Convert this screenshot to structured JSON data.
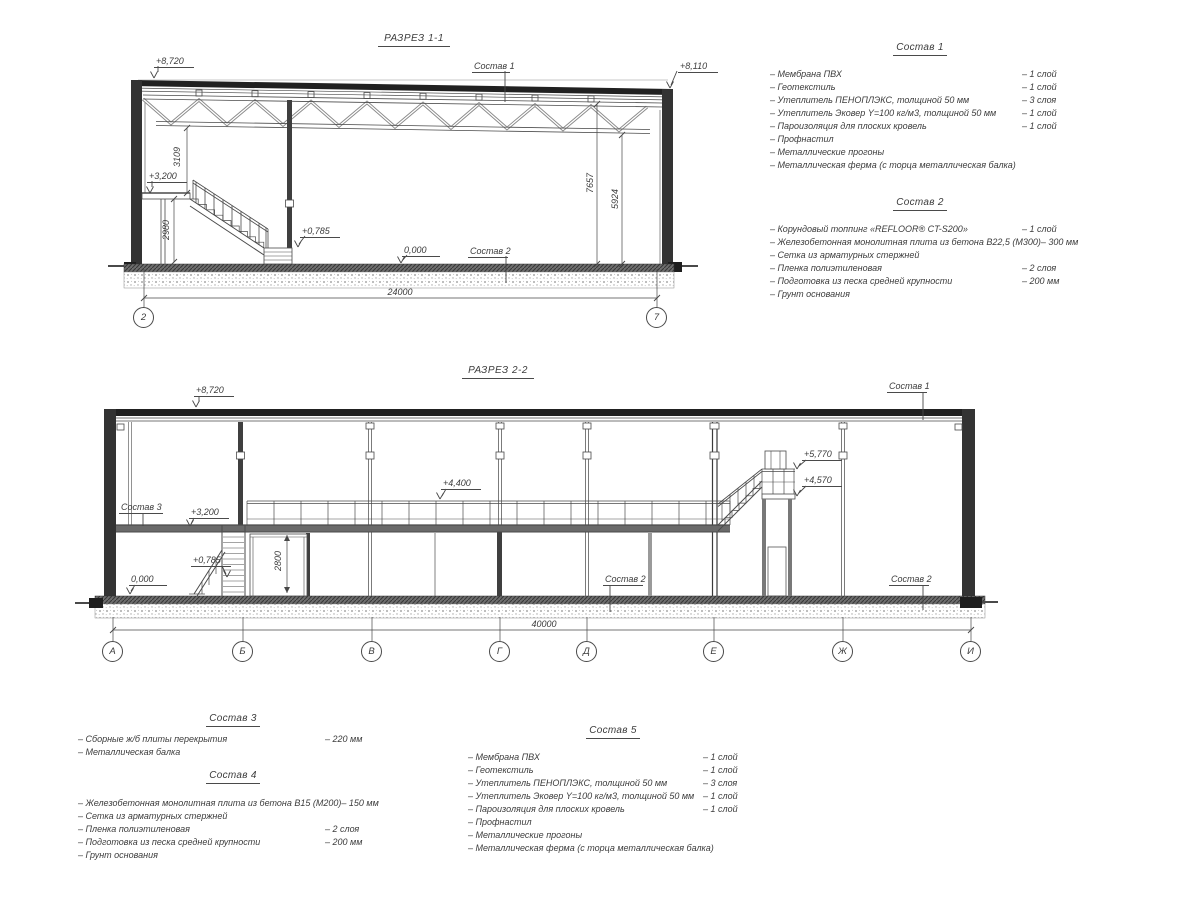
{
  "section1": {
    "title": "РАЗРЕЗ 1-1",
    "labels": {
      "elev_top_left": "+8,720",
      "elev_top_right": "+8,110",
      "sostav1": "Состав 1",
      "sostav2": "Состав 2",
      "elev_3200": "+3,200",
      "elev_0785": "+0,785",
      "elev_0000": "0,000",
      "dim_3109": "3109",
      "dim_2980": "2980",
      "dim_7657": "7657",
      "dim_5924": "5924",
      "dim_total": "24000",
      "axis_left": "2",
      "axis_right": "7"
    }
  },
  "section2": {
    "title": "РАЗРЕЗ 2-2",
    "labels": {
      "elev_top": "+8,720",
      "sostav1": "Состав 1",
      "sostav3": "Состав 3",
      "sostav2_mid": "Состав 2",
      "sostav2_right": "Состав 2",
      "elev_3200": "+3,200",
      "elev_4400": "+4,400",
      "elev_5770": "+5,770",
      "elev_4570": "+4,570",
      "elev_0785": "+0,785",
      "elev_0000": "0,000",
      "dim_2800": "2800",
      "dim_total": "40000"
    },
    "axes": [
      "А",
      "Б",
      "В",
      "Г",
      "Д",
      "Е",
      "Ж",
      "И"
    ]
  },
  "legends": {
    "s1": {
      "title": "Состав 1",
      "items": [
        {
          "name": "– Мембрана ПВХ",
          "value": "– 1 слой"
        },
        {
          "name": "– Геотекстиль",
          "value": "– 1 слой"
        },
        {
          "name": "– Утеплитель ПЕНОПЛЭКС, толщиной 50 мм",
          "value": "– 3 слоя"
        },
        {
          "name": "– Утеплитель Эковер Y=100 кг/м3, толщиной 50 мм",
          "value": "– 1 слой"
        },
        {
          "name": "– Пароизоляция для плоских кровель",
          "value": "– 1 слой"
        },
        {
          "name": "– Профнастил",
          "value": ""
        },
        {
          "name": "– Металлические прогоны",
          "value": ""
        },
        {
          "name": "– Металлическая ферма (с торца металлическая балка)",
          "value": ""
        }
      ]
    },
    "s2": {
      "title": "Состав 2",
      "items": [
        {
          "name": "– Корундовый топпинг «REFLOOR® CT-S200»",
          "value": "– 1 слой"
        },
        {
          "name": "– Железобетонная  монолитная плита из бетона В22,5 (М300)",
          "value": "– 300 мм"
        },
        {
          "name": "– Сетка из арматурных стержней",
          "value": ""
        },
        {
          "name": "– Пленка полиэтиленовая",
          "value": "– 2 слоя"
        },
        {
          "name": "– Подготовка из песка средней крупности",
          "value": "– 200 мм"
        },
        {
          "name": "– Грунт основания",
          "value": ""
        }
      ]
    },
    "s3": {
      "title": "Состав 3",
      "items": [
        {
          "name": "– Сборные ж/б плиты перекрытия",
          "value": "– 220 мм"
        },
        {
          "name": "– Металлическая балка",
          "value": ""
        }
      ]
    },
    "s4": {
      "title": "Состав 4",
      "items": [
        {
          "name": "– Железобетонная  монолитная плита из бетона В15 (М200)",
          "value": "– 150 мм"
        },
        {
          "name": "– Сетка из арматурных стержней",
          "value": ""
        },
        {
          "name": "– Пленка полиэтиленовая",
          "value": "– 2 слоя"
        },
        {
          "name": "– Подготовка из песка средней крупности",
          "value": "– 200 мм"
        },
        {
          "name": "– Грунт основания",
          "value": ""
        }
      ]
    },
    "s5": {
      "title": "Состав 5",
      "items": [
        {
          "name": "– Мембрана ПВХ",
          "value": "– 1 слой"
        },
        {
          "name": "– Геотекстиль",
          "value": "– 1 слой"
        },
        {
          "name": "– Утеплитель ПЕНОПЛЭКС, толщиной 50 мм",
          "value": "– 3 слоя"
        },
        {
          "name": "– Утеплитель Эковер Y=100 кг/м3, толщиной 50 мм",
          "value": "– 1 слой"
        },
        {
          "name": "– Пароизоляция для плоских кровель",
          "value": "– 1 слой"
        },
        {
          "name": "– Профнастил",
          "value": ""
        },
        {
          "name": "– Металлические прогоны",
          "value": ""
        },
        {
          "name": "– Металлическая ферма (с торца металлическая балка)",
          "value": ""
        }
      ]
    }
  }
}
